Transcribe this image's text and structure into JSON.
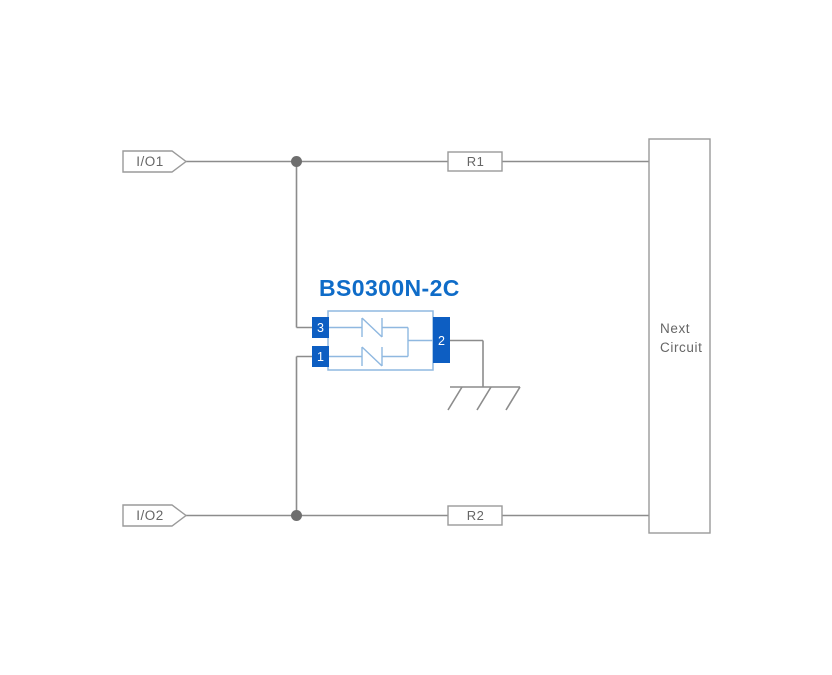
{
  "component": {
    "title": "BS0300N-2C",
    "pins": {
      "pin1": "1",
      "pin2": "2",
      "pin3": "3"
    }
  },
  "connectors": {
    "io1": "I/O1",
    "io2": "I/O2"
  },
  "resistors": {
    "r1": "R1",
    "r2": "R2"
  },
  "next_circuit": {
    "line1": "Next",
    "line2": "Circuit"
  },
  "colors": {
    "background": "#ffffff",
    "wire_gray": "#8c8c8c",
    "outline_gray": "#9a9a9a",
    "junction_dot": "#6e6e6e",
    "label_text": "#666666",
    "component_outline_blue": "#8fb8e0",
    "component_pin_blue": "#0d5ec2",
    "title_blue": "#0f6cc8",
    "pin_text": "#ffffff"
  }
}
